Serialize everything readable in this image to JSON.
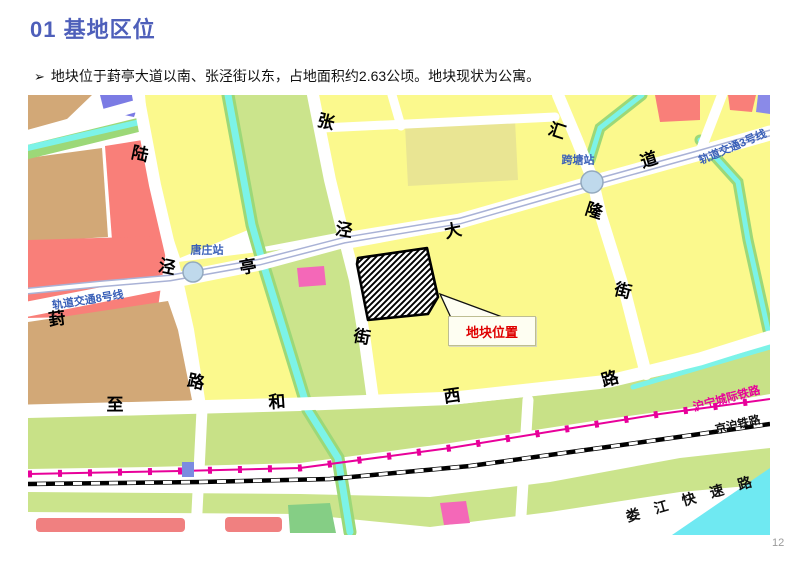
{
  "slide": {
    "title": "01 基地区位",
    "bullet_marker": "➢",
    "bullet_text": "地块位于葑亭大道以南、张泾街以东，占地面积约2.63公顷。地块现状为公寓。",
    "page_number": "12"
  },
  "map": {
    "roads": [
      {
        "name": "陆泾路"
      },
      {
        "name": "张泾街"
      },
      {
        "name": "汇隆街"
      },
      {
        "name": "葑亭大道"
      },
      {
        "name": "至和西路"
      },
      {
        "name": "娄江快速路"
      }
    ],
    "stations": [
      {
        "name": "唐庄站"
      },
      {
        "name": "跨塘站"
      }
    ],
    "rail_lines": [
      {
        "name": "轨道交通8号线"
      },
      {
        "name": "轨道交通3号线"
      },
      {
        "name": "沪宁城际铁路"
      },
      {
        "name": "京沪铁路"
      }
    ],
    "labels": [
      {
        "text": "陆"
      },
      {
        "text": "泾"
      },
      {
        "text": "路"
      },
      {
        "text": "张"
      },
      {
        "text": "泾"
      },
      {
        "text": "街"
      },
      {
        "text": "汇"
      },
      {
        "text": "隆"
      },
      {
        "text": "街"
      },
      {
        "text": "葑"
      },
      {
        "text": "亭"
      },
      {
        "text": "大"
      },
      {
        "text": "道"
      },
      {
        "text": "至"
      },
      {
        "text": "和"
      },
      {
        "text": "西"
      },
      {
        "text": "路"
      },
      {
        "text": "唐庄站"
      },
      {
        "text": "跨塘站"
      },
      {
        "text": "轨道交通8号线"
      },
      {
        "text": "轨道交通3号线"
      },
      {
        "text": "沪宁城际铁路"
      },
      {
        "text": "京沪铁路"
      },
      {
        "text": "娄江快速路"
      }
    ],
    "callout": {
      "text": "地块位置"
    },
    "site_area": "2.63公顷",
    "colors": {
      "title_blue": "#4E5FBA",
      "parcel_yellow": "#FBF98D",
      "parcel_khaki": "#E9E593",
      "parcel_green": "#CBE48C",
      "parcel_tan": "#D2A877",
      "parcel_red": "#F97F79",
      "parcel_blue": "#7B7BE4",
      "parcel_pink": "#F468B8",
      "canal_cyan": "#7CF3E8",
      "rail_lavender": "#A9B2D6",
      "rail_text_blue": "#3A60B8",
      "intercity_magenta": "#E8009A",
      "site_label_red": "#DF0000"
    }
  }
}
